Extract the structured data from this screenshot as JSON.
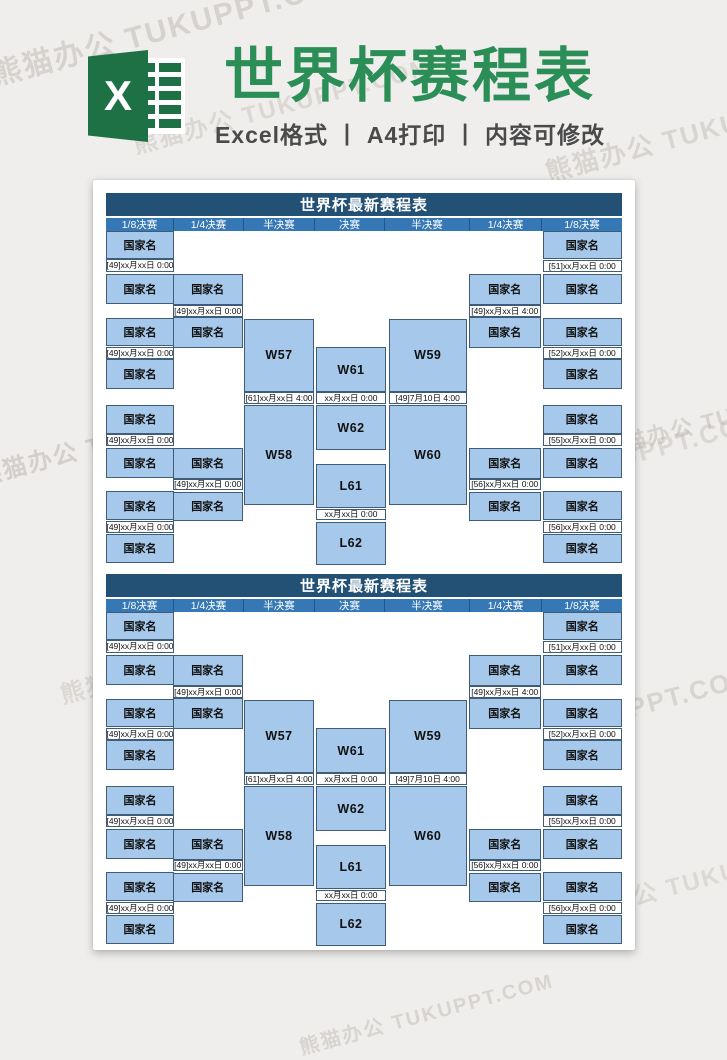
{
  "header": {
    "title": "世界杯赛程表",
    "subtitle": "Excel格式 丨 A4打印 丨 内容可修改",
    "icon_letter": "X"
  },
  "watermark_text": "熊猫办公 TUKUPPT.COM",
  "colors": {
    "title_green": "#2b8e57",
    "excel_green": "#1e7145",
    "navy": "#235175",
    "header_blue": "#3578b5",
    "cell_fill": "#a6c8ea",
    "cell_border": "#3f5c79",
    "date_fill": "#fefefe",
    "page_bg": "#ffffff",
    "canvas_bg": "#efeeec",
    "subtitle_color": "#4a4a4b",
    "wm_color": "#beb7af"
  },
  "table": {
    "title": "世界杯最新赛程表",
    "round_headers": [
      "1/8决赛",
      "1/4决赛",
      "半决赛",
      "决赛",
      "半决赛",
      "1/4决赛",
      "1/8决赛"
    ],
    "columns": [
      {
        "round": "1/8决赛-left",
        "cells": [
          {
            "kind": "team",
            "label": "国家名"
          },
          {
            "kind": "date",
            "label": "[49]xx月xx日 0:00"
          },
          {
            "kind": "team",
            "label": "国家名"
          },
          {
            "kind": "team",
            "label": "国家名"
          },
          {
            "kind": "date",
            "label": "[49]xx月xx日 0:00"
          },
          {
            "kind": "team",
            "label": "国家名"
          },
          {
            "kind": "team",
            "label": "国家名"
          },
          {
            "kind": "date",
            "label": "[49]xx月xx日 0:00"
          },
          {
            "kind": "team",
            "label": "国家名"
          },
          {
            "kind": "team",
            "label": "国家名"
          },
          {
            "kind": "date",
            "label": "[49]xx月xx日 0:00"
          },
          {
            "kind": "team",
            "label": "国家名"
          }
        ]
      },
      {
        "round": "1/4决赛-left",
        "cells": [
          {
            "kind": "team",
            "label": "国家名"
          },
          {
            "kind": "date",
            "label": "[49]xx月xx日 0:00"
          },
          {
            "kind": "team",
            "label": "国家名"
          },
          {
            "kind": "team",
            "label": "国家名"
          },
          {
            "kind": "date",
            "label": "[49]xx月xx日 0:00"
          },
          {
            "kind": "team",
            "label": "国家名"
          }
        ]
      },
      {
        "round": "半决赛-left",
        "cells": [
          {
            "kind": "match",
            "label": "W57"
          },
          {
            "kind": "date",
            "label": "[61]xx月xx日 4:00"
          },
          {
            "kind": "match",
            "label": "W58"
          }
        ]
      },
      {
        "round": "决赛",
        "cells": [
          {
            "kind": "match",
            "label": "W61"
          },
          {
            "kind": "date",
            "label": "xx月xx日 0:00"
          },
          {
            "kind": "match",
            "label": "W62"
          },
          {
            "kind": "match",
            "label": "L61"
          },
          {
            "kind": "date",
            "label": "xx月xx日 0:00"
          },
          {
            "kind": "match",
            "label": "L62"
          }
        ]
      },
      {
        "round": "半决赛-right",
        "cells": [
          {
            "kind": "match",
            "label": "W59"
          },
          {
            "kind": "date",
            "label": "[49]7月10日 4:00"
          },
          {
            "kind": "match",
            "label": "W60"
          }
        ]
      },
      {
        "round": "1/4决赛-right",
        "cells": [
          {
            "kind": "team",
            "label": "国家名"
          },
          {
            "kind": "date",
            "label": "[49]xx月xx日 4:00"
          },
          {
            "kind": "team",
            "label": "国家名"
          },
          {
            "kind": "team",
            "label": "国家名"
          },
          {
            "kind": "date",
            "label": "[56]xx月xx日 0:00"
          },
          {
            "kind": "team",
            "label": "国家名"
          }
        ]
      },
      {
        "round": "1/8决赛-right",
        "cells": [
          {
            "kind": "team",
            "label": "国家名"
          },
          {
            "kind": "date",
            "label": "[51]xx月xx日 0:00"
          },
          {
            "kind": "team",
            "label": "国家名"
          },
          {
            "kind": "team",
            "label": "国家名"
          },
          {
            "kind": "date",
            "label": "[52]xx月xx日 0:00"
          },
          {
            "kind": "team",
            "label": "国家名"
          },
          {
            "kind": "team",
            "label": "国家名"
          },
          {
            "kind": "date",
            "label": "[55]xx月xx日 0:00"
          },
          {
            "kind": "team",
            "label": "国家名"
          },
          {
            "kind": "team",
            "label": "国家名"
          },
          {
            "kind": "date",
            "label": "[56]xx月xx日 0:00"
          },
          {
            "kind": "team",
            "label": "国家名"
          }
        ]
      }
    ]
  }
}
